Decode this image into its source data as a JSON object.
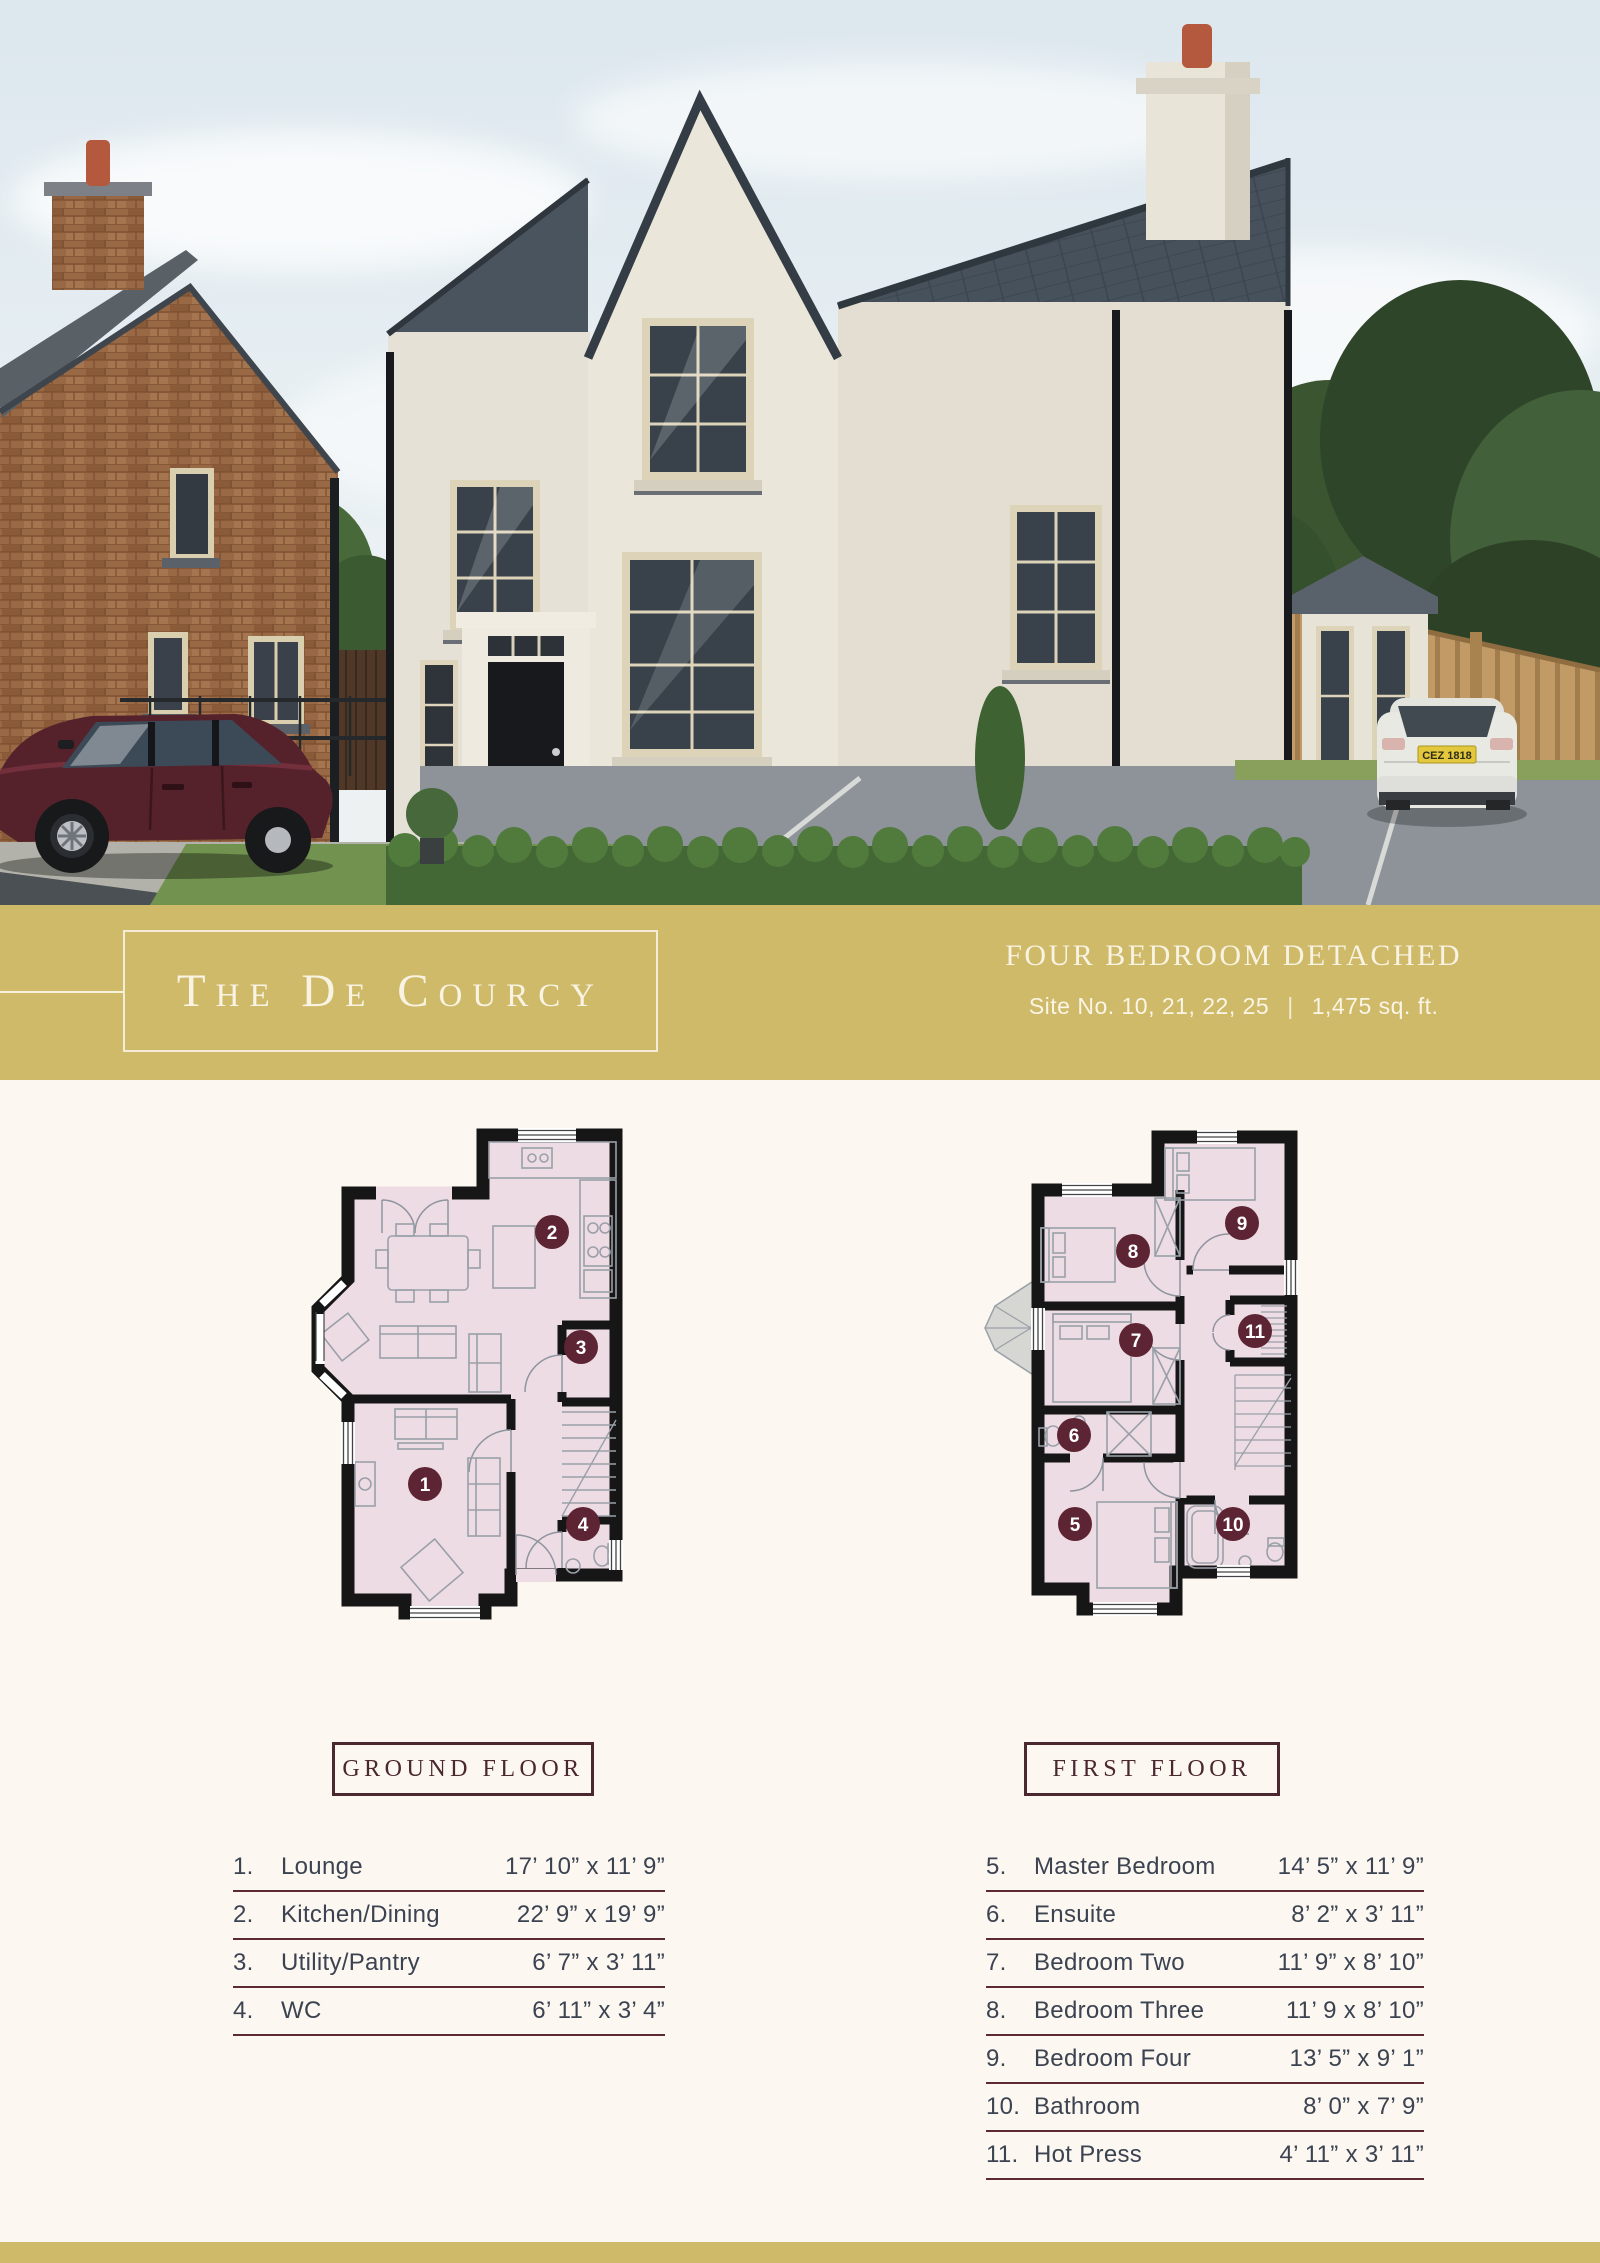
{
  "banner": {
    "title": "The De Courcy",
    "category": "FOUR BEDROOM DETACHED",
    "site": "Site No. 10, 21, 22, 25",
    "separator": "|",
    "area": "1,475 sq. ft."
  },
  "photo": {
    "plate": "CEZ 1818"
  },
  "plans": {
    "ground": {
      "label": "GROUND FLOOR",
      "markers": [
        "1",
        "2",
        "3",
        "4"
      ]
    },
    "first": {
      "label": "FIRST FLOOR",
      "markers": [
        "5",
        "6",
        "7",
        "8",
        "9",
        "10",
        "11"
      ]
    }
  },
  "tables": {
    "ground": {
      "rows": [
        {
          "num": "1.",
          "name": "Lounge",
          "dims": "17’ 10” x 11’ 9”"
        },
        {
          "num": "2.",
          "name": "Kitchen/Dining",
          "dims": "22’ 9” x 19’ 9”"
        },
        {
          "num": "3.",
          "name": "Utility/Pantry",
          "dims": "6’ 7” x 3’ 11”"
        },
        {
          "num": "4.",
          "name": "WC",
          "dims": "6’ 11” x 3’ 4”"
        }
      ]
    },
    "first": {
      "rows": [
        {
          "num": "5.",
          "name": "Master Bedroom",
          "dims": "14’ 5” x 11’ 9”"
        },
        {
          "num": "6.",
          "name": "Ensuite",
          "dims": "8’ 2” x 3’ 11”"
        },
        {
          "num": "7.",
          "name": "Bedroom Two",
          "dims": "11’ 9” x 8’ 10”"
        },
        {
          "num": "8.",
          "name": "Bedroom Three",
          "dims": "11’ 9 x 8’ 10”"
        },
        {
          "num": "9.",
          "name": "Bedroom Four",
          "dims": "13’ 5” x 9’ 1”"
        },
        {
          "num": "10.",
          "name": "Bathroom",
          "dims": "8’ 0” x 7’ 9”"
        },
        {
          "num": "11.",
          "name": "Hot Press",
          "dims": "4’ 11” x 3’ 11”"
        }
      ]
    }
  },
  "colors": {
    "banner_gold": "#cfba69",
    "page_cream": "#fcf7f1",
    "marker_maroon": "#5d2433",
    "plan_wall": "#161616",
    "plan_fill": "#eedce5",
    "table_text": "#3b4351",
    "table_rule": "#5d2936",
    "label_maroon": "#4b2730"
  }
}
